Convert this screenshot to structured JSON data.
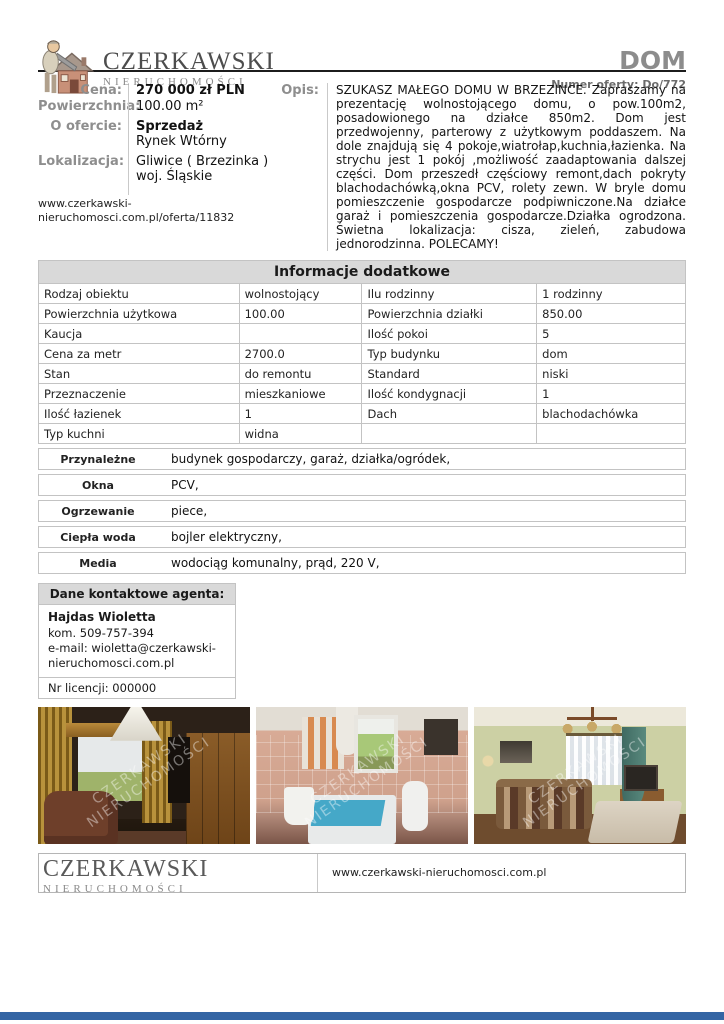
{
  "header": {
    "brand_name": "CZERKAWSKI",
    "brand_sub": "NIERUCHOMOŚCI",
    "doc_type": "DOM",
    "offer_number": "Numer oferty: Do/772"
  },
  "summary": {
    "cena_label": "Cena:",
    "cena_value": "270 000 zł PLN",
    "area_label": "Powierzchnia:",
    "area_value": "100.00 m²",
    "offer_label": "O ofercie:",
    "offer_value_1": "Sprzedaż",
    "offer_value_2": "Rynek Wtórny",
    "location_label": "Lokalizacja:",
    "location_value_1": "Gliwice ( Brzezinka )",
    "location_value_2": "woj. Śląskie",
    "offer_url": "www.czerkawski-nieruchomosci.com.pl/oferta/11832"
  },
  "opis": {
    "label": "Opis:",
    "text": "SZUKASZ MAŁEGO DOMU W BRZEZINCE. Zapraszamy na prezentację wolnostojącego domu, o pow.100m2, posadowionego na działce 850m2. Dom jest przedwojenny, parterowy z użytkowym poddaszem. Na dole znajdują się 4 pokoje,wiatrołap,kuchnia,łazienka. Na strychu jest 1 pokój ,możliwość zaadaptowania dalszej części. Dom przeszedł częściowy remont,dach pokryty blachodachówką,okna PCV, rolety zewn. W bryle domu pomieszczenie gospodarcze podpiwniczone.Na działce garaż i pomieszczenia gospodarcze.Działka ogrodzona. Świetna lokalizacja: cisza, zieleń, zabudowa jednorodzinna. POLECAMY!"
  },
  "info_table": {
    "title": "Informacje dodatkowe",
    "rows": [
      {
        "l1": "Rodzaj obiektu",
        "v1": "wolnostojący",
        "l2": "Ilu rodzinny",
        "v2": "1 rodzinny"
      },
      {
        "l1": "Powierzchnia użytkowa",
        "v1": "100.00",
        "l2": "Powierzchnia działki",
        "v2": "850.00"
      },
      {
        "l1": "Kaucja",
        "v1": "",
        "l2": "Ilość pokoi",
        "v2": "5"
      },
      {
        "l1": "Cena za metr",
        "v1": "2700.0",
        "l2": "Typ budynku",
        "v2": "dom"
      },
      {
        "l1": "Stan",
        "v1": "do remontu",
        "l2": "Standard",
        "v2": "niski"
      },
      {
        "l1": "Przeznaczenie",
        "v1": "mieszkaniowe",
        "l2": "Ilość kondygnacji",
        "v2": "1"
      },
      {
        "l1": "Ilość łazienek",
        "v1": "1",
        "l2": "Dach",
        "v2": "blachodachówka"
      },
      {
        "l1": "Typ kuchni",
        "v1": "widna",
        "l2": "",
        "v2": ""
      }
    ]
  },
  "features": {
    "rows": [
      {
        "label": "Przynależne",
        "value": "budynek gospodarczy, garaż, działka/ogródek,"
      },
      {
        "label": "Okna",
        "value": "PCV,"
      },
      {
        "label": "Ogrzewanie",
        "value": "piece,"
      },
      {
        "label": "Ciepła woda",
        "value": "bojler elektryczny,"
      },
      {
        "label": "Media",
        "value": "wodociąg komunalny, prąd, 220 V,"
      }
    ]
  },
  "agent": {
    "title": "Dane kontaktowe agenta:",
    "name": "Hajdas Wioletta",
    "phone": "kom. 509-757-394",
    "email": "e-mail: wioletta@czerkawski-nieruchomosci.com.pl",
    "license": "Nr licencji: 000000"
  },
  "photos": {
    "watermark_line1": "CZERKAWSKI",
    "watermark_line2": "NIERUCHOMOŚCI",
    "items": [
      {
        "alt": "dark living room with gold curtains, armchair and wooden cabinet"
      },
      {
        "alt": "bathroom with pink tiles, bathtub with blue cover and toilet"
      },
      {
        "alt": "living room with green walls, striped sofa, table and window"
      }
    ]
  },
  "footer": {
    "brand_name": "CZERKAWSKI",
    "brand_sub": "NIERUCHOMOŚCI",
    "website": "www.czerkawski-nieruchomosci.com.pl"
  },
  "colors": {
    "bottom_bar": "#3465a4",
    "table_header_bg": "#d9d9d9",
    "label_gray": "#8e8e8e",
    "border_gray": "#c3c3c3"
  }
}
